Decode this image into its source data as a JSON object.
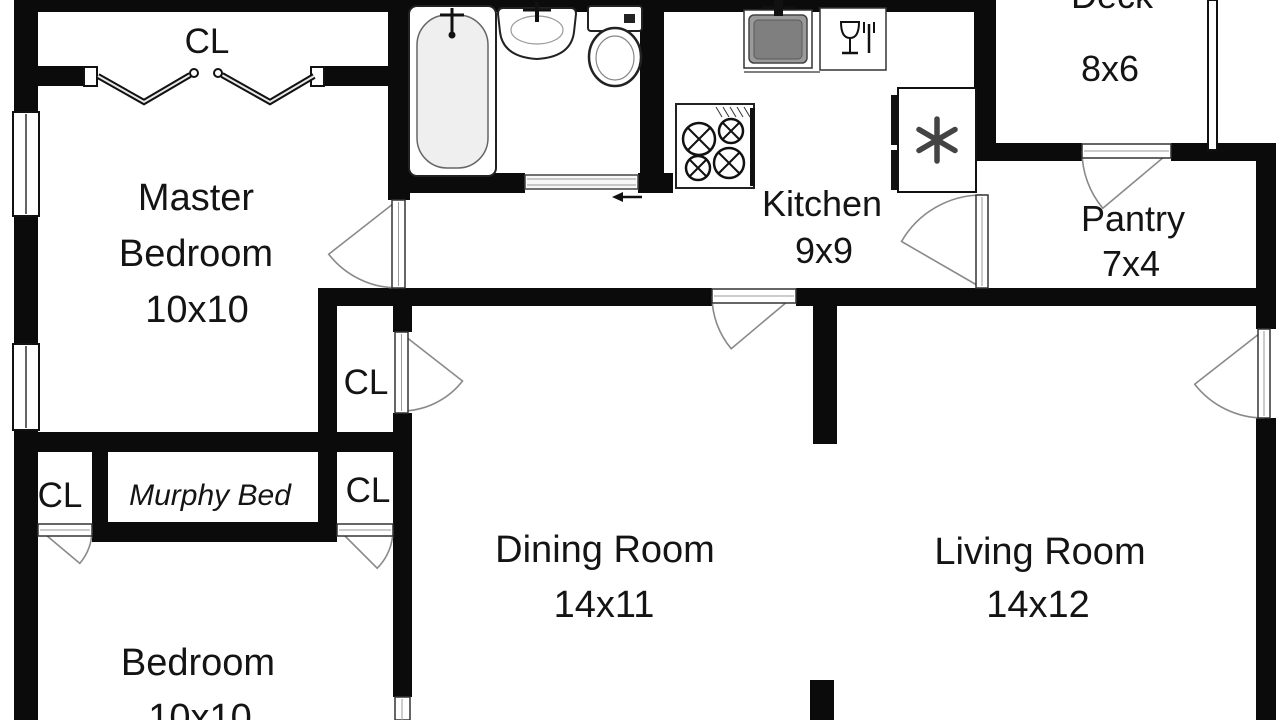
{
  "title": "apartment-floor-plan",
  "rooms": {
    "closet_top": {
      "label": "CL"
    },
    "master_bedroom": {
      "name_line1": "Master",
      "name_line2": "Bedroom",
      "dims": "10x10"
    },
    "kitchen": {
      "name": "Kitchen",
      "dims": "9x9"
    },
    "deck": {
      "name": "Deck",
      "dims": "8x6"
    },
    "pantry": {
      "name": "Pantry",
      "dims": "7x4"
    },
    "closet_hall": {
      "label": "CL"
    },
    "closet_left": {
      "label": "CL"
    },
    "murphy_bed": {
      "label": "Murphy Bed"
    },
    "closet_right": {
      "label": "CL"
    },
    "dining_room": {
      "name": "Dining Room",
      "dims": "14x11"
    },
    "living_room": {
      "name": "Living Room",
      "dims": "14x12"
    },
    "bedroom": {
      "name": "Bedroom",
      "dims": "10x10"
    }
  },
  "fixtures": [
    "bathtub",
    "bathroom-sink",
    "toilet",
    "kitchen-sink",
    "dishwasher",
    "stove",
    "refrigerator"
  ],
  "colors": {
    "background": "#ffffff",
    "wall": "#0b0b0b",
    "door_arc": "#8a8a8a",
    "fixture_outline": "#222222",
    "sink_basin": "#7f7f7f",
    "tub_interior": "#efefef"
  }
}
